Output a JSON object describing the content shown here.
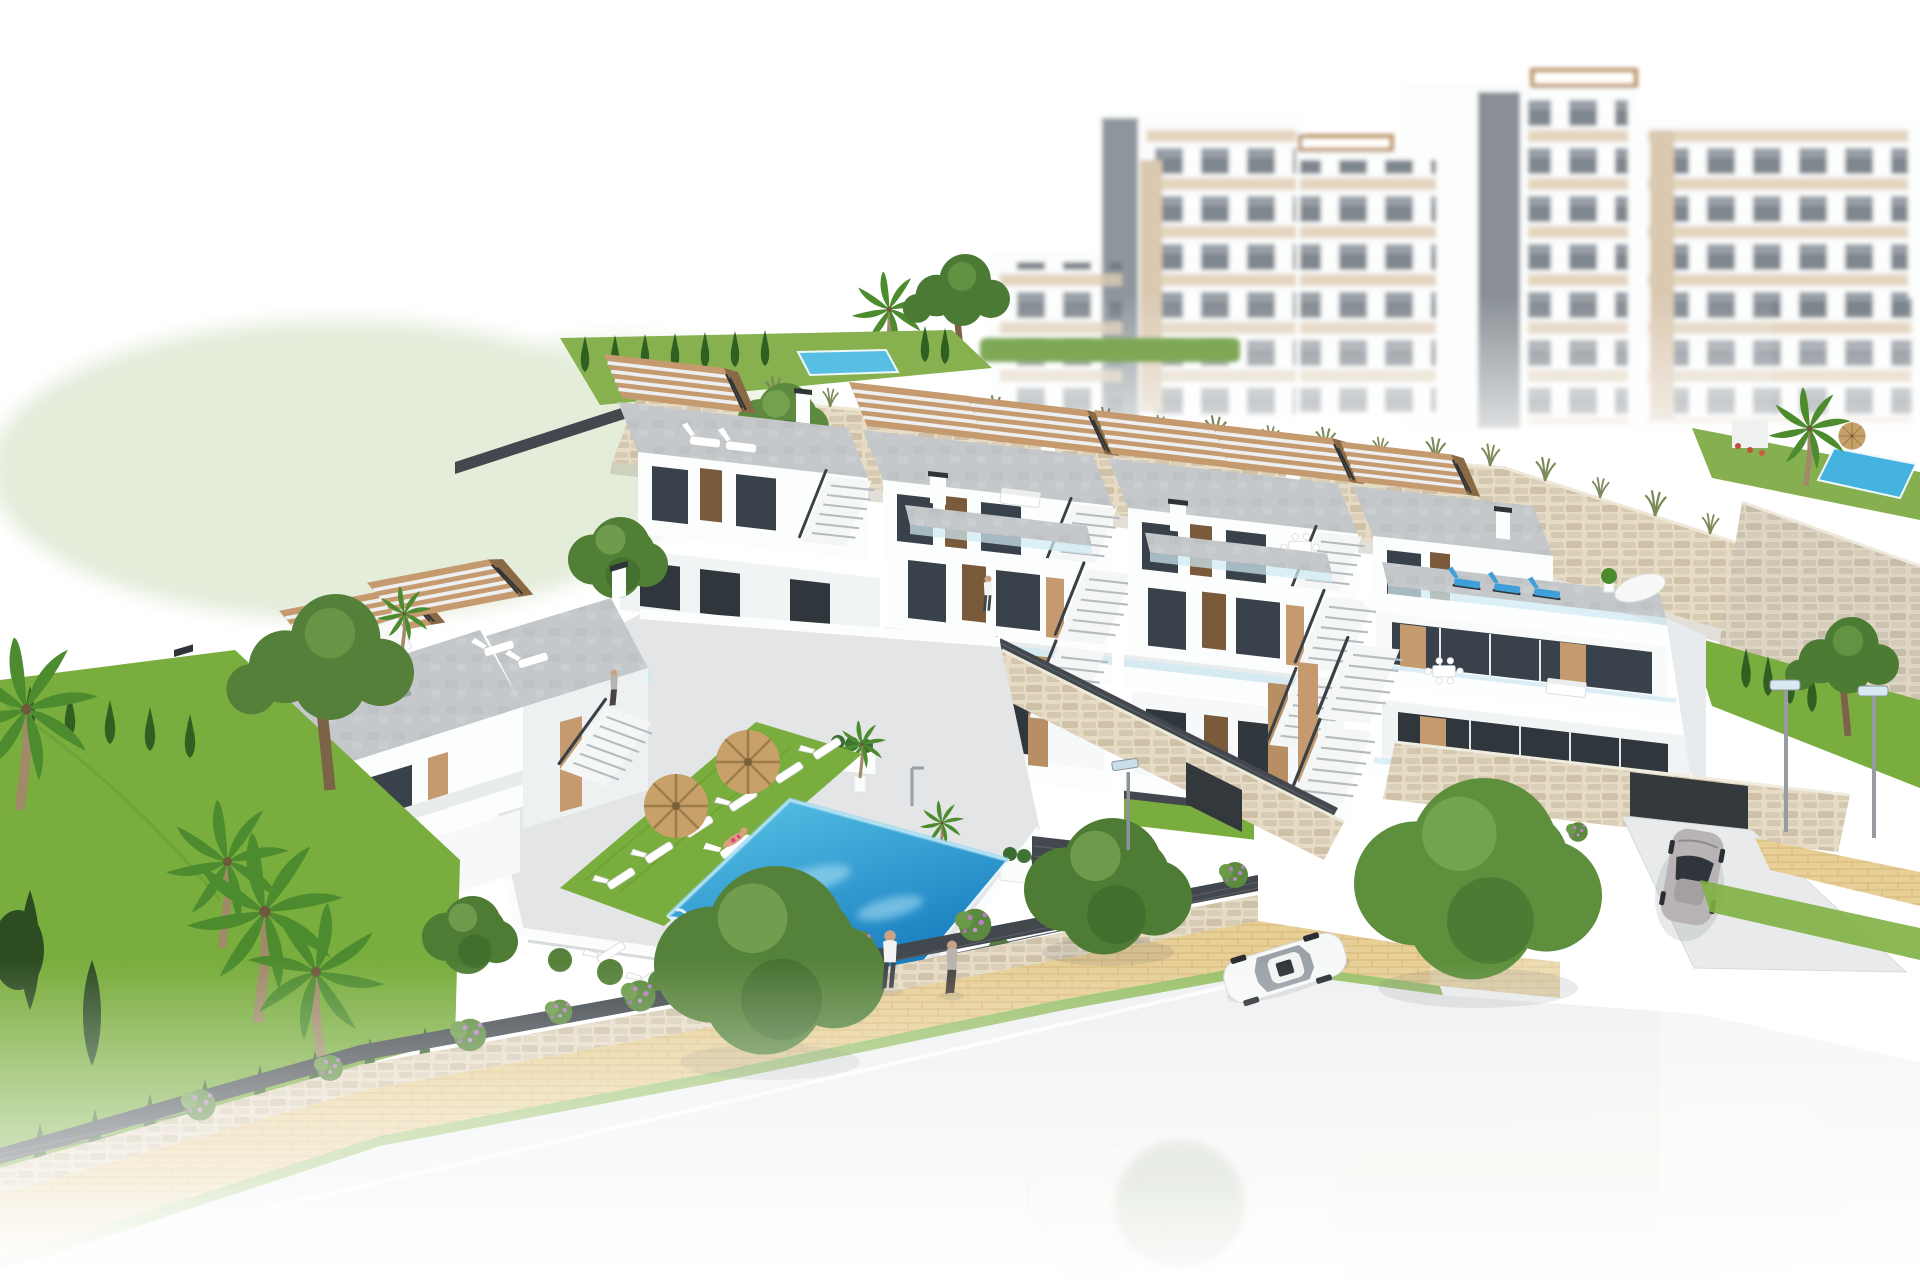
{
  "meta": {
    "title": "Aerial 3D architectural rendering of a white hillside residential development with communal pool, gardens and street",
    "image_type": "architectural-render",
    "view": "aerial axonometric",
    "background": "pure white studio fade"
  },
  "palette": {
    "background": "#ffffff",
    "building_white": "#fcfdfd",
    "building_shadow": "#e7ebed",
    "roof_deck_gray": "#c5c8ca",
    "wood_accent": "#c49a6e",
    "door_wood": "#7a5a3b",
    "window_glass": "#39424a",
    "glass_balustrade": "#cfe9f2",
    "stone_wall_light": "#e6dcc6",
    "stone_wall_gray": "#ded5c5",
    "lawn_green": "#79ad3d",
    "cypress_green": "#2f6022",
    "tree_green": "#55823a",
    "pool_blue_light": "#5bc6e8",
    "pool_blue_deep": "#1479bd",
    "umbrella_straw": "#c7a06a",
    "path_tan": "#e7cf96",
    "road_gray": "#eff0f1",
    "fence_dark": "#42484d",
    "car_white": "#f7f8f8",
    "car_silver": "#b8b3b5",
    "flower_purple": "#b77fc4"
  },
  "scene": {
    "background_apartments": {
      "label": "hazy white apartment blocks with beige panels and elevator shafts",
      "blocks": 6,
      "roof_pergolas": 2
    },
    "hillside": {
      "stone_retaining_walls": 4,
      "upper_garden_lap_pool": 1,
      "grass_tufts": "along wall tops"
    },
    "upper_townhouse_row": {
      "units": 4,
      "features": [
        "roof terraces",
        "wooden pergolas",
        "external stairs"
      ]
    },
    "front_townhouse_left_block": {
      "units": 2,
      "roof_items": [
        "white parasol",
        "two gray loungers",
        "double pergola",
        "dining table"
      ]
    },
    "front_townhouse_right_block": {
      "units": 3,
      "roof_items": [
        "three blue loungers",
        "white parasol",
        "plants"
      ],
      "garage": "underground entrance with driveway"
    },
    "pool_courtyard": {
      "pool": "slanted rectangular blue pool",
      "sun_loungers": 8,
      "straw_umbrellas": 2,
      "planters": 2,
      "outdoor_shower": 1
    },
    "vegetation": {
      "palm_trees": 7,
      "pine_trees": 4,
      "cypresses": 30,
      "round_trees": 6,
      "purple_flower_bushes": 12,
      "lawns": 4
    },
    "circulation": {
      "paved_path": "tan paver promenade along boundary wall",
      "road": "light street fading to white",
      "driveway": 1
    },
    "vehicles": {
      "white_sedan": 1,
      "silver_sports_car": 1,
      "faded_cars_bottom": 2
    },
    "people": {
      "walking_on_path": 2,
      "sunbathing_on_lounger": 1,
      "swimming": 1,
      "on_terraces": 2
    },
    "street_lamps": 3
  }
}
